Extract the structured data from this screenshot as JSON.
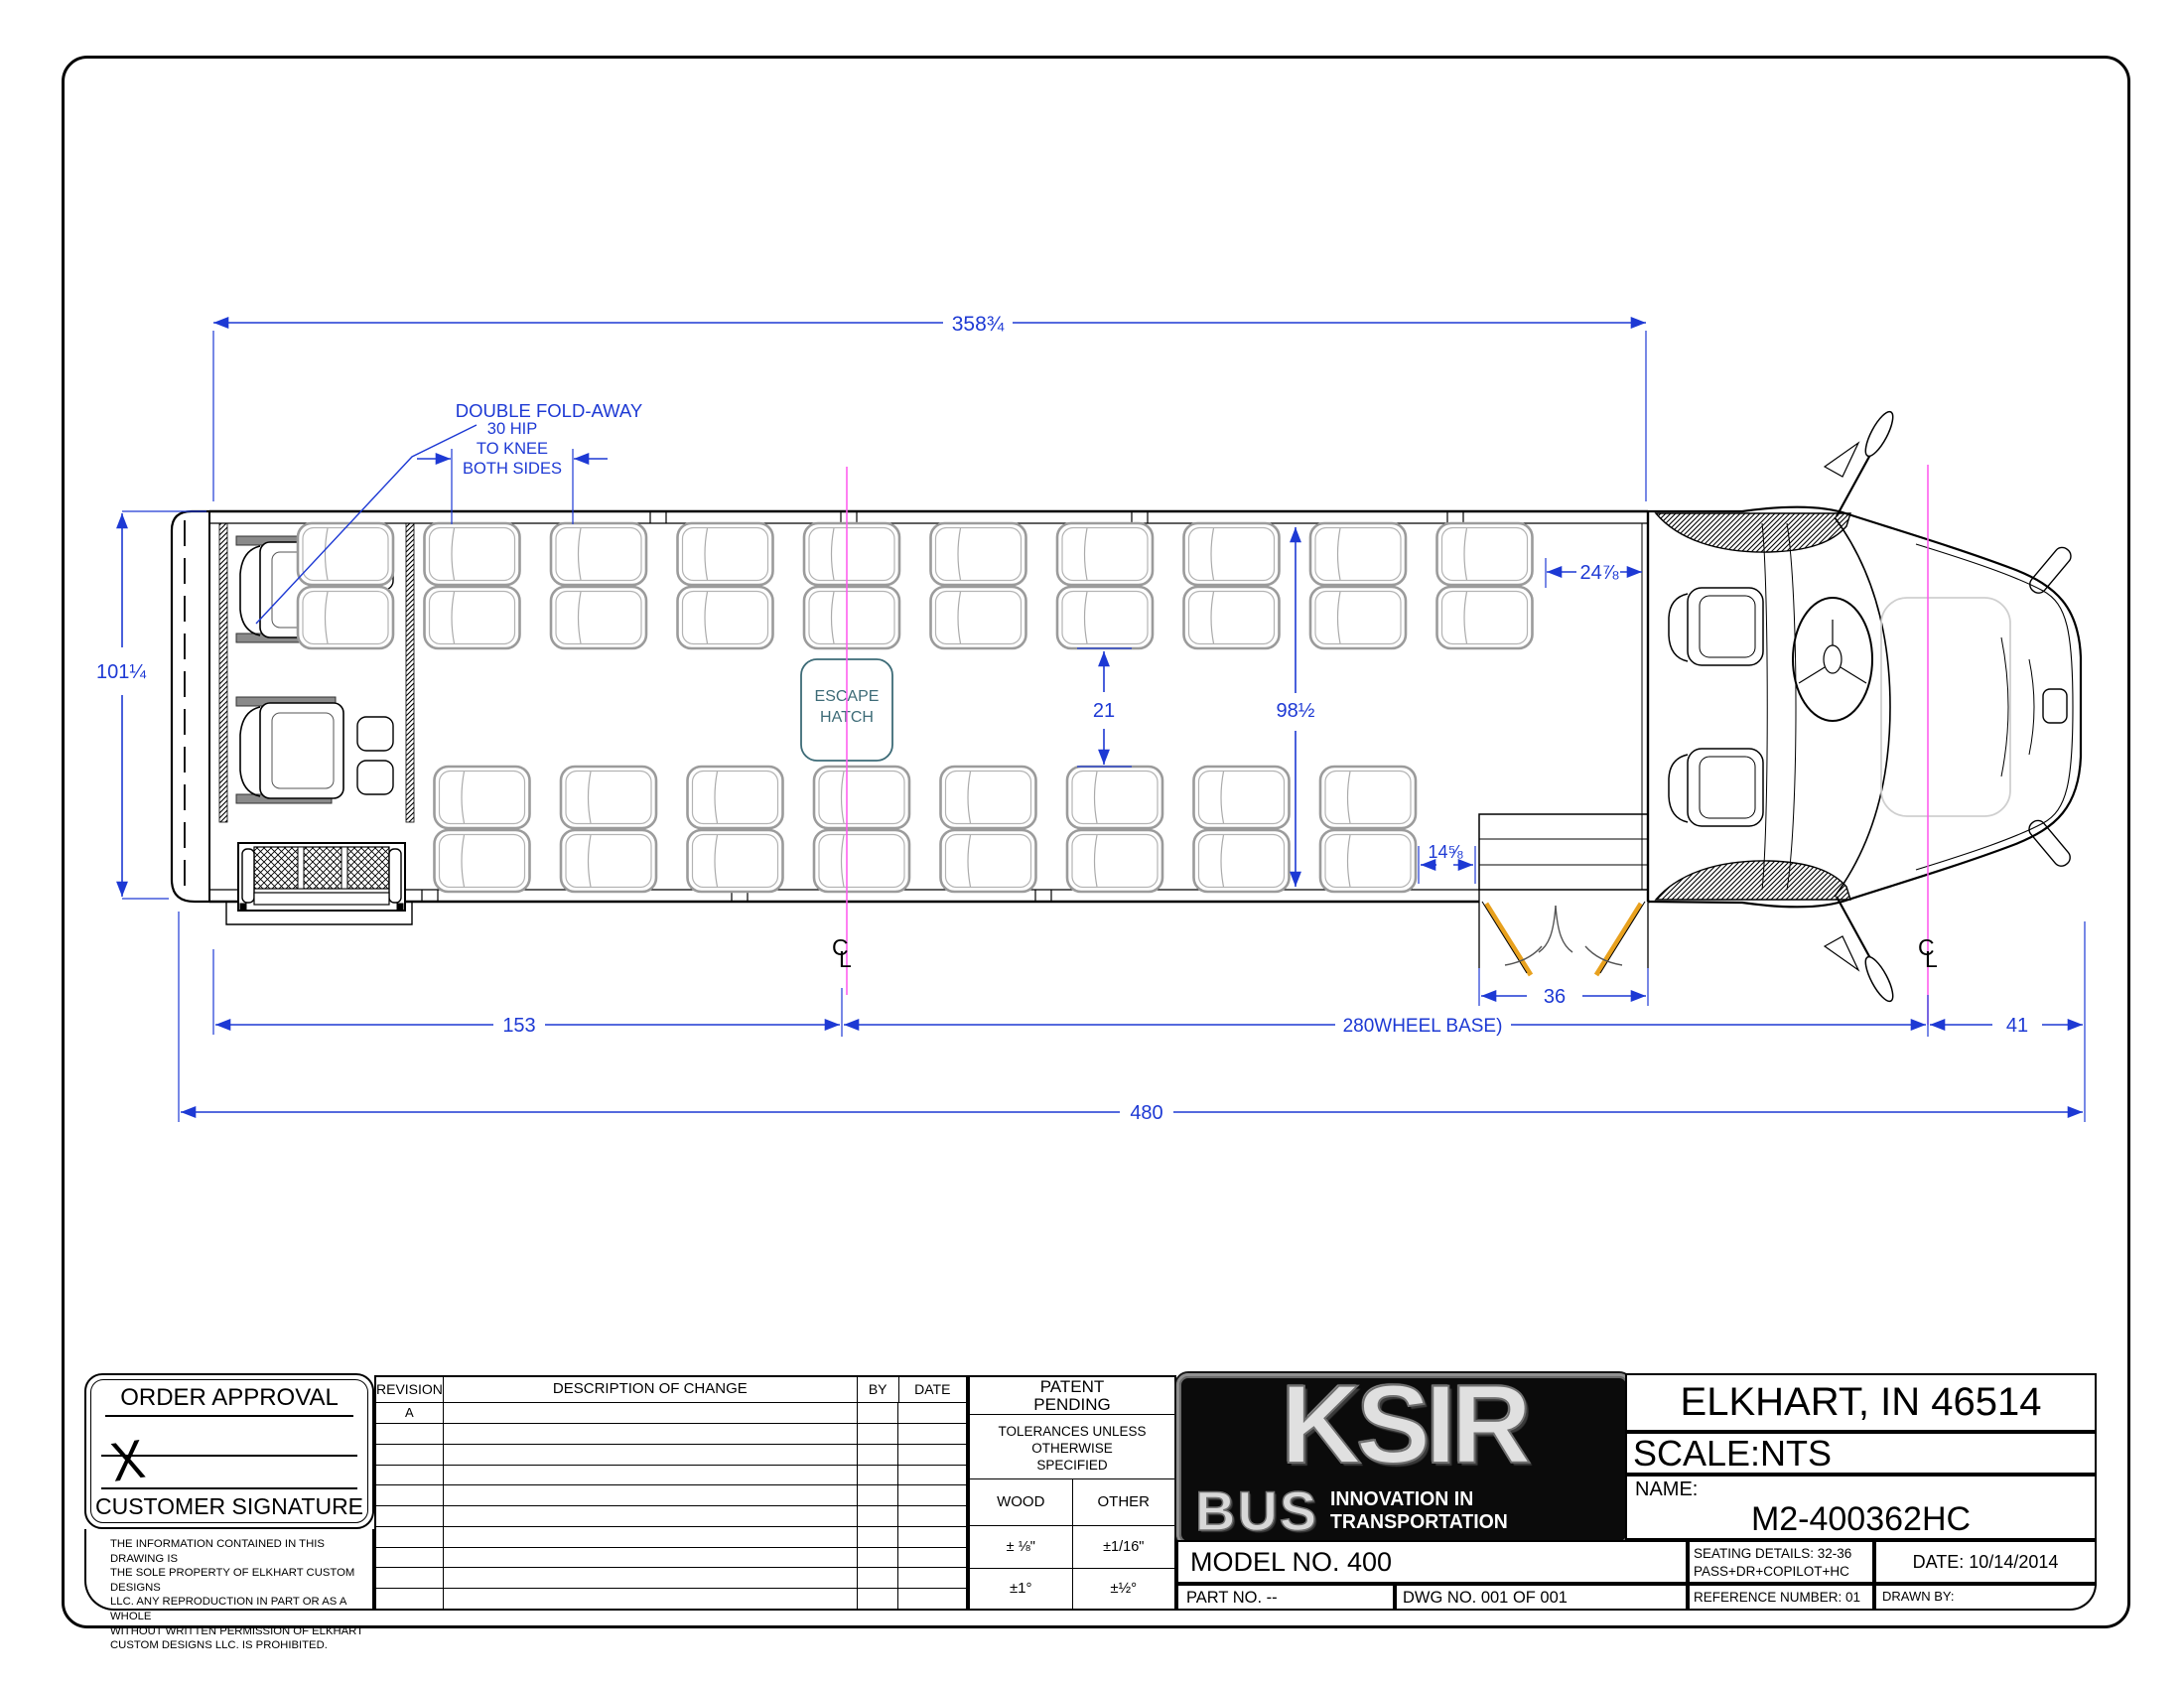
{
  "drawing": {
    "colors": {
      "dimension": "#1d39d4",
      "centerline": "#ff55ee",
      "door": "#e8a11e",
      "escape": "#3d6b77",
      "seat": "#9b9b9b"
    },
    "labels": {
      "double_fold_away": "DOUBLE FOLD-AWAY",
      "hip1": "30 HIP",
      "hip2": "TO KNEE",
      "hip3": "BOTH SIDES",
      "escape1": "ESCAPE",
      "escape2": "HATCH",
      "cl_c": "C",
      "cl_l": "L"
    },
    "dims": {
      "body_length": "358¾",
      "rear_width": "101¼",
      "front_gap": "24⅞",
      "aisle": "21",
      "interior": "98½",
      "seat_to_door": "14⅝",
      "door": "36",
      "rear_overhang": "153",
      "wheelbase": "280WHEEL BASE)",
      "front_overhang": "41",
      "overall": "480"
    }
  },
  "title_block": {
    "order": {
      "title": "ORDER APPROVAL",
      "x": "X",
      "signature": "CUSTOMER SIGNATURE"
    },
    "disclaimer": [
      "THE INFORMATION CONTAINED IN THIS DRAWING IS",
      "THE SOLE PROPERTY OF ELKHART CUSTOM DESIGNS",
      "LLC. ANY REPRODUCTION IN PART OR AS A WHOLE",
      "WITHOUT WRITTEN PERMISSION OF ELKHART",
      "CUSTOM DESIGNS LLC. IS PROHIBITED."
    ],
    "revision": {
      "headers": [
        "REVISION",
        "DESCRIPTION OF CHANGE",
        "BY",
        "DATE"
      ],
      "rows": [
        [
          "A",
          "",
          "",
          ""
        ],
        [
          "",
          "",
          "",
          ""
        ],
        [
          "",
          "",
          "",
          ""
        ],
        [
          "",
          "",
          "",
          ""
        ],
        [
          "",
          "",
          "",
          ""
        ],
        [
          "",
          "",
          "",
          ""
        ],
        [
          "",
          "",
          "",
          ""
        ],
        [
          "",
          "",
          "",
          ""
        ],
        [
          "",
          "",
          "",
          ""
        ],
        [
          "",
          "",
          "",
          ""
        ]
      ]
    },
    "patent": {
      "l1": "PATENT",
      "l2": "PENDING"
    },
    "tol": {
      "l1": "TOLERANCES UNLESS",
      "l2": "OTHERWISE",
      "l3": "SPECIFIED",
      "wood": "WOOD",
      "other": "OTHER",
      "wood_len": "± ⅛\"",
      "other_len": "±1/16\"",
      "wood_ang": "±1°",
      "other_ang": "±½°"
    },
    "logo": {
      "brand": "KSIR",
      "bus": "BUS",
      "tag1": "INNOVATION IN",
      "tag2": "TRANSPORTATION"
    },
    "rows": {
      "model": "MODEL NO.  400",
      "part": "PART NO. --",
      "dwg": "DWG  NO. 001 OF 001"
    },
    "right": {
      "city": "ELKHART, IN 46514",
      "scale": "SCALE:NTS",
      "name_label": "NAME:",
      "name_value": "M2-400362HC",
      "seating1": "SEATING DETAILS: 32-36",
      "seating2": "PASS+DR+COPILOT+HC",
      "date": "DATE: 10/14/2014",
      "reference": "REFERENCE NUMBER: 01",
      "drawn_by": "DRAWN BY:"
    }
  }
}
